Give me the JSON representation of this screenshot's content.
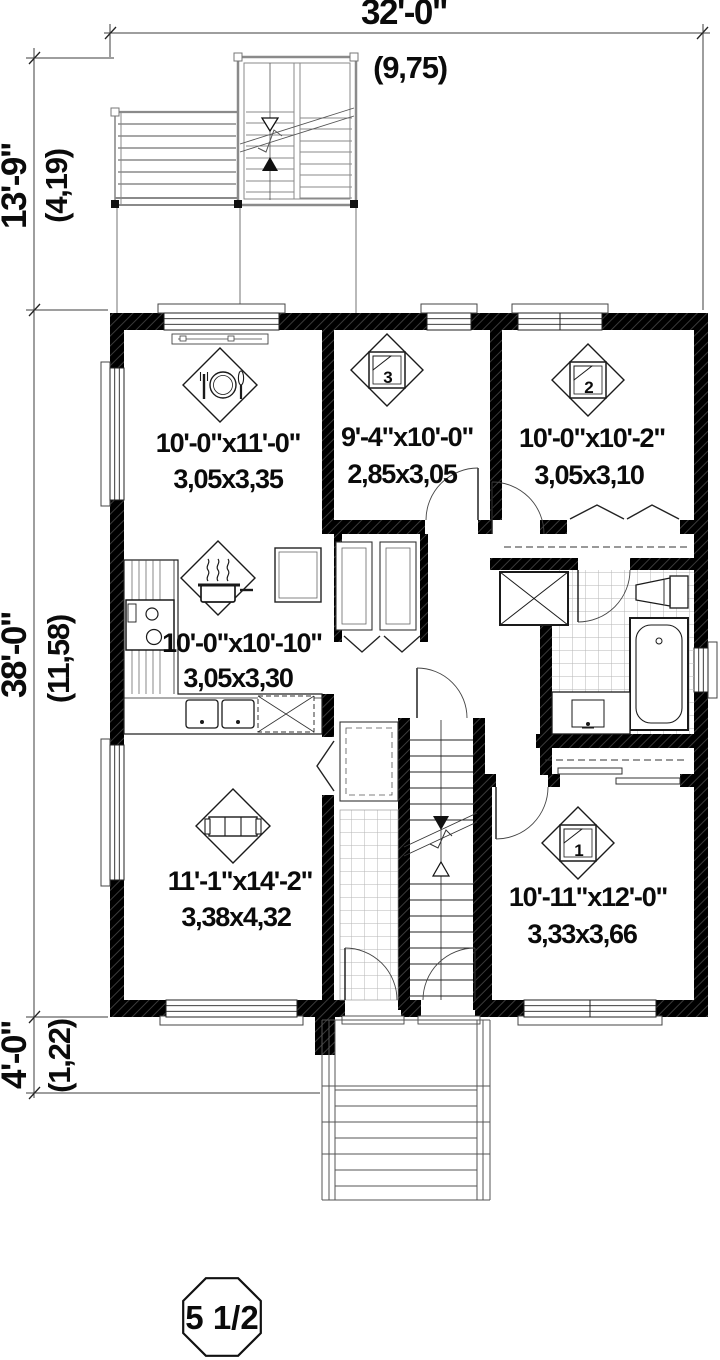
{
  "dimensions": {
    "top": {
      "imperial": "32'-0\"",
      "metric": "(9,75)"
    },
    "left_upper": {
      "imperial": "13'-9\"",
      "metric": "(4,19)"
    },
    "left_main": {
      "imperial": "38'-0\"",
      "metric": "(11,58)"
    },
    "left_lower": {
      "imperial": "4'-0\"",
      "metric": "(1,22)"
    }
  },
  "rooms": {
    "dining": {
      "icon": "dining-icon",
      "imperial": "10'-0\"x11'-0\"",
      "metric": "3,05x3,35"
    },
    "bedroom3": {
      "icon": "bed-icon",
      "number": "3",
      "imperial": "9'-4\"x10'-0\"",
      "metric": "2,85x3,05"
    },
    "bedroom2": {
      "icon": "bed-icon",
      "number": "2",
      "imperial": "10'-0\"x10'-2\"",
      "metric": "3,05x3,10"
    },
    "kitchen": {
      "icon": "cooking-pot-icon",
      "imperial": "10'-0\"x10'-10\"",
      "metric": "3,05x3,30"
    },
    "living": {
      "icon": "sofa-icon",
      "imperial": "11'-1\"x14'-2\"",
      "metric": "3,38x4,32"
    },
    "bedroom1": {
      "icon": "bed-icon",
      "number": "1",
      "imperial": "10'-11\"x12'-0\"",
      "metric": "3,33x3,66"
    }
  },
  "badge": {
    "label": "5 1/2"
  },
  "colors": {
    "wall": "#000000",
    "line": "#3c3c3c",
    "light_line": "#8a8a8a",
    "tile": "#b5b5b5",
    "background": "#ffffff"
  }
}
